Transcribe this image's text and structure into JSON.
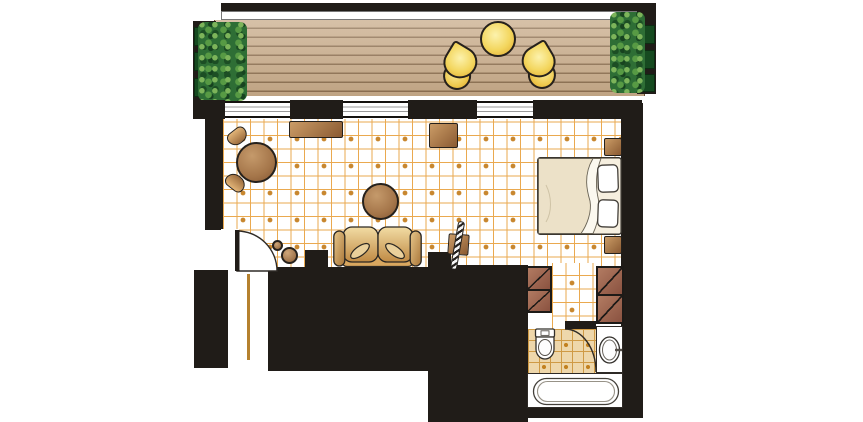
{
  "document": {
    "kind": "architectural floor plan",
    "depicts": "hotel guest room: balcony with deck, living/sleeping room, entry corridor, bathroom",
    "text_labels": []
  },
  "palette": {
    "wall": "#201c18",
    "tile_line": "#eaa94f",
    "tile_dot": "#c8872f",
    "bath_floor": "#eed7ab",
    "deck_wood": "#c9ac8a",
    "deck_groove": "#5d3f21",
    "foliage": "#2e6e35",
    "planter_box": "#164a20",
    "balcony_furniture_yellow": "#f3d65e",
    "wood_furniture_brown": "#a5764a",
    "sofa_tan": "#d9a75f",
    "bed_linen": "#f5eedd",
    "fixture_white": "#ffffff",
    "outline": "#26211c",
    "threshold_line": "#b5812f"
  },
  "areas": {
    "balcony": {
      "items": [
        "hedge-left",
        "planter-boxes-left",
        "wood-deck",
        "railing",
        "balcony-table",
        "balcony-chair-left",
        "balcony-chair-right",
        "hedge-right",
        "planter-boxes-right"
      ]
    },
    "living_bedroom": {
      "items": [
        "dining-table",
        "dining-chair-upper",
        "dining-chair-lower",
        "console-table",
        "tv-stand",
        "coffee-table",
        "sofa",
        "throw-pillows",
        "side-stool-small",
        "side-stool-large",
        "luggage-rack",
        "double-bed",
        "bed-pillows",
        "nightstand-upper",
        "nightstand-lower"
      ]
    },
    "entry": {
      "items": [
        "entry-door",
        "entry-corridor",
        "threshold-strip"
      ]
    },
    "bathroom": {
      "items": [
        "wardrobe-left",
        "wardrobe-right",
        "toilet",
        "bathroom-door",
        "sink",
        "bathtub"
      ]
    },
    "windows": {
      "count": 3
    },
    "doors": {
      "count": 2
    }
  }
}
